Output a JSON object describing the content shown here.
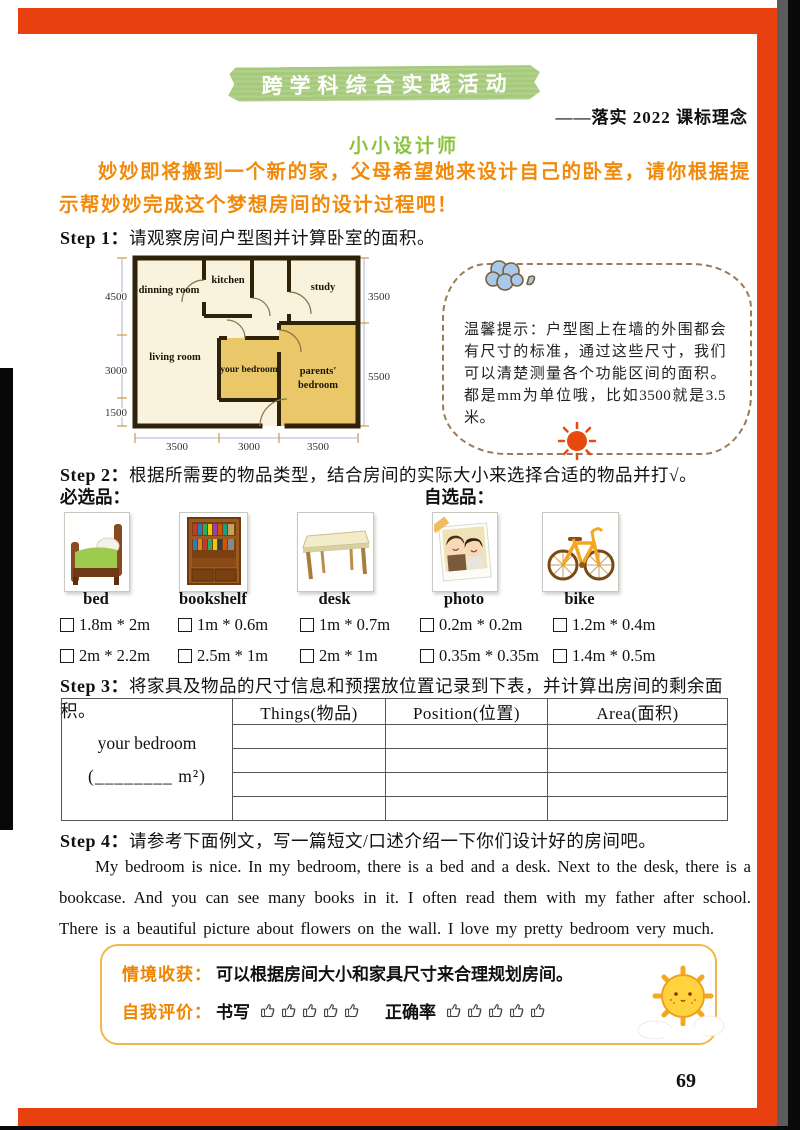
{
  "banner": {
    "title": "跨学科综合实践活动",
    "subtitle": "——落实 2022 课标理念"
  },
  "heading": "小小设计师",
  "intro": "妙妙即将搬到一个新的家，父母希望她来设计自己的卧室，请你根据提示帮妙妙完成这个梦想房间的设计过程吧！",
  "steps": {
    "step1": {
      "label": "Step 1",
      "colon": "：",
      "text": "请观察房间户型图并计算卧室的面积。"
    },
    "step2": {
      "label": "Step 2",
      "colon": "：",
      "text": "根据所需要的物品类型，结合房间的实际大小来选择合适的物品并打√。"
    },
    "step3": {
      "label": "Step 3",
      "colon": "：",
      "text": "将家具及物品的尺寸信息和预摆放位置记录到下表，并计算出房间的剩余面积。"
    },
    "step4": {
      "label": "Step 4",
      "colon": "：",
      "text": "请参考下面例文，写一篇短文/口述介绍一下你们设计好的房间吧。"
    }
  },
  "floorplan": {
    "rooms": {
      "dinning": "dinning room",
      "kitchen": "kitchen",
      "study": "study",
      "living": "living room",
      "your_bedroom": "your bedroom",
      "parents_line1": "parents'",
      "parents_line2": "bedroom"
    },
    "dims": {
      "left_top": "4500",
      "left_mid": "3000",
      "left_bottom": "1500",
      "right_top": "3500",
      "right_mid": "5500",
      "bottom_left": "3500",
      "bottom_mid": "3000",
      "bottom_right": "3500"
    }
  },
  "tip": {
    "text": "温馨提示：户型图上在墙的外围都会有尺寸的标准，通过这些尺寸，我们可以清楚测量各个功能区间的面积。都是mm为单位哦，比如3500就是3.5米。"
  },
  "catalog": {
    "required_label": "必选品：",
    "optional_label": "自选品：",
    "items": [
      {
        "label": "bed",
        "size1": "1.8m * 2m",
        "size2": "2m * 2.2m"
      },
      {
        "label": "bookshelf",
        "size1": "1m * 0.6m",
        "size2": "2.5m * 1m"
      },
      {
        "label": "desk",
        "size1": "1m * 0.7m",
        "size2": "2m * 1m"
      },
      {
        "label": "photo",
        "size1": "0.2m * 0.2m",
        "size2": "0.35m * 0.35m"
      },
      {
        "label": "bike",
        "size1": "1.2m * 0.4m",
        "size2": "1.4m * 0.5m"
      }
    ]
  },
  "table": {
    "row_label_line1": "your bedroom",
    "row_label_line2": "(________ m²)",
    "headers": [
      "Things(物品)",
      "Position(位置)",
      "Area(面积)"
    ]
  },
  "example": {
    "text": "My bedroom is nice. In my bedroom, there is a bed and a desk. Next to the desk, there is a bookcase. And you can see many books in it. I often read them with my father after school. There is a beautiful picture about flowers on the wall. I love my pretty bedroom very much."
  },
  "summary": {
    "gain_label": "情境收获：",
    "gain_text": "可以根据房间大小和家具尺寸来合理规划房间。",
    "eval_label": "自我评价：",
    "writing_label": "书写",
    "accuracy_label": "正确率",
    "thumb_count": 5
  },
  "page_number": "69",
  "colors": {
    "frame_orange": "#e8400e",
    "banner_green": "#a6ca7b",
    "heading_green": "#8bc341",
    "intro_orange": "#f18a0a",
    "summary_orange": "#f08300",
    "box_border_yellow": "#f3b64b",
    "bedroom_fill": "#eac768",
    "plan_background": "#f9f3dd",
    "wall_brown": "#2e2209"
  }
}
